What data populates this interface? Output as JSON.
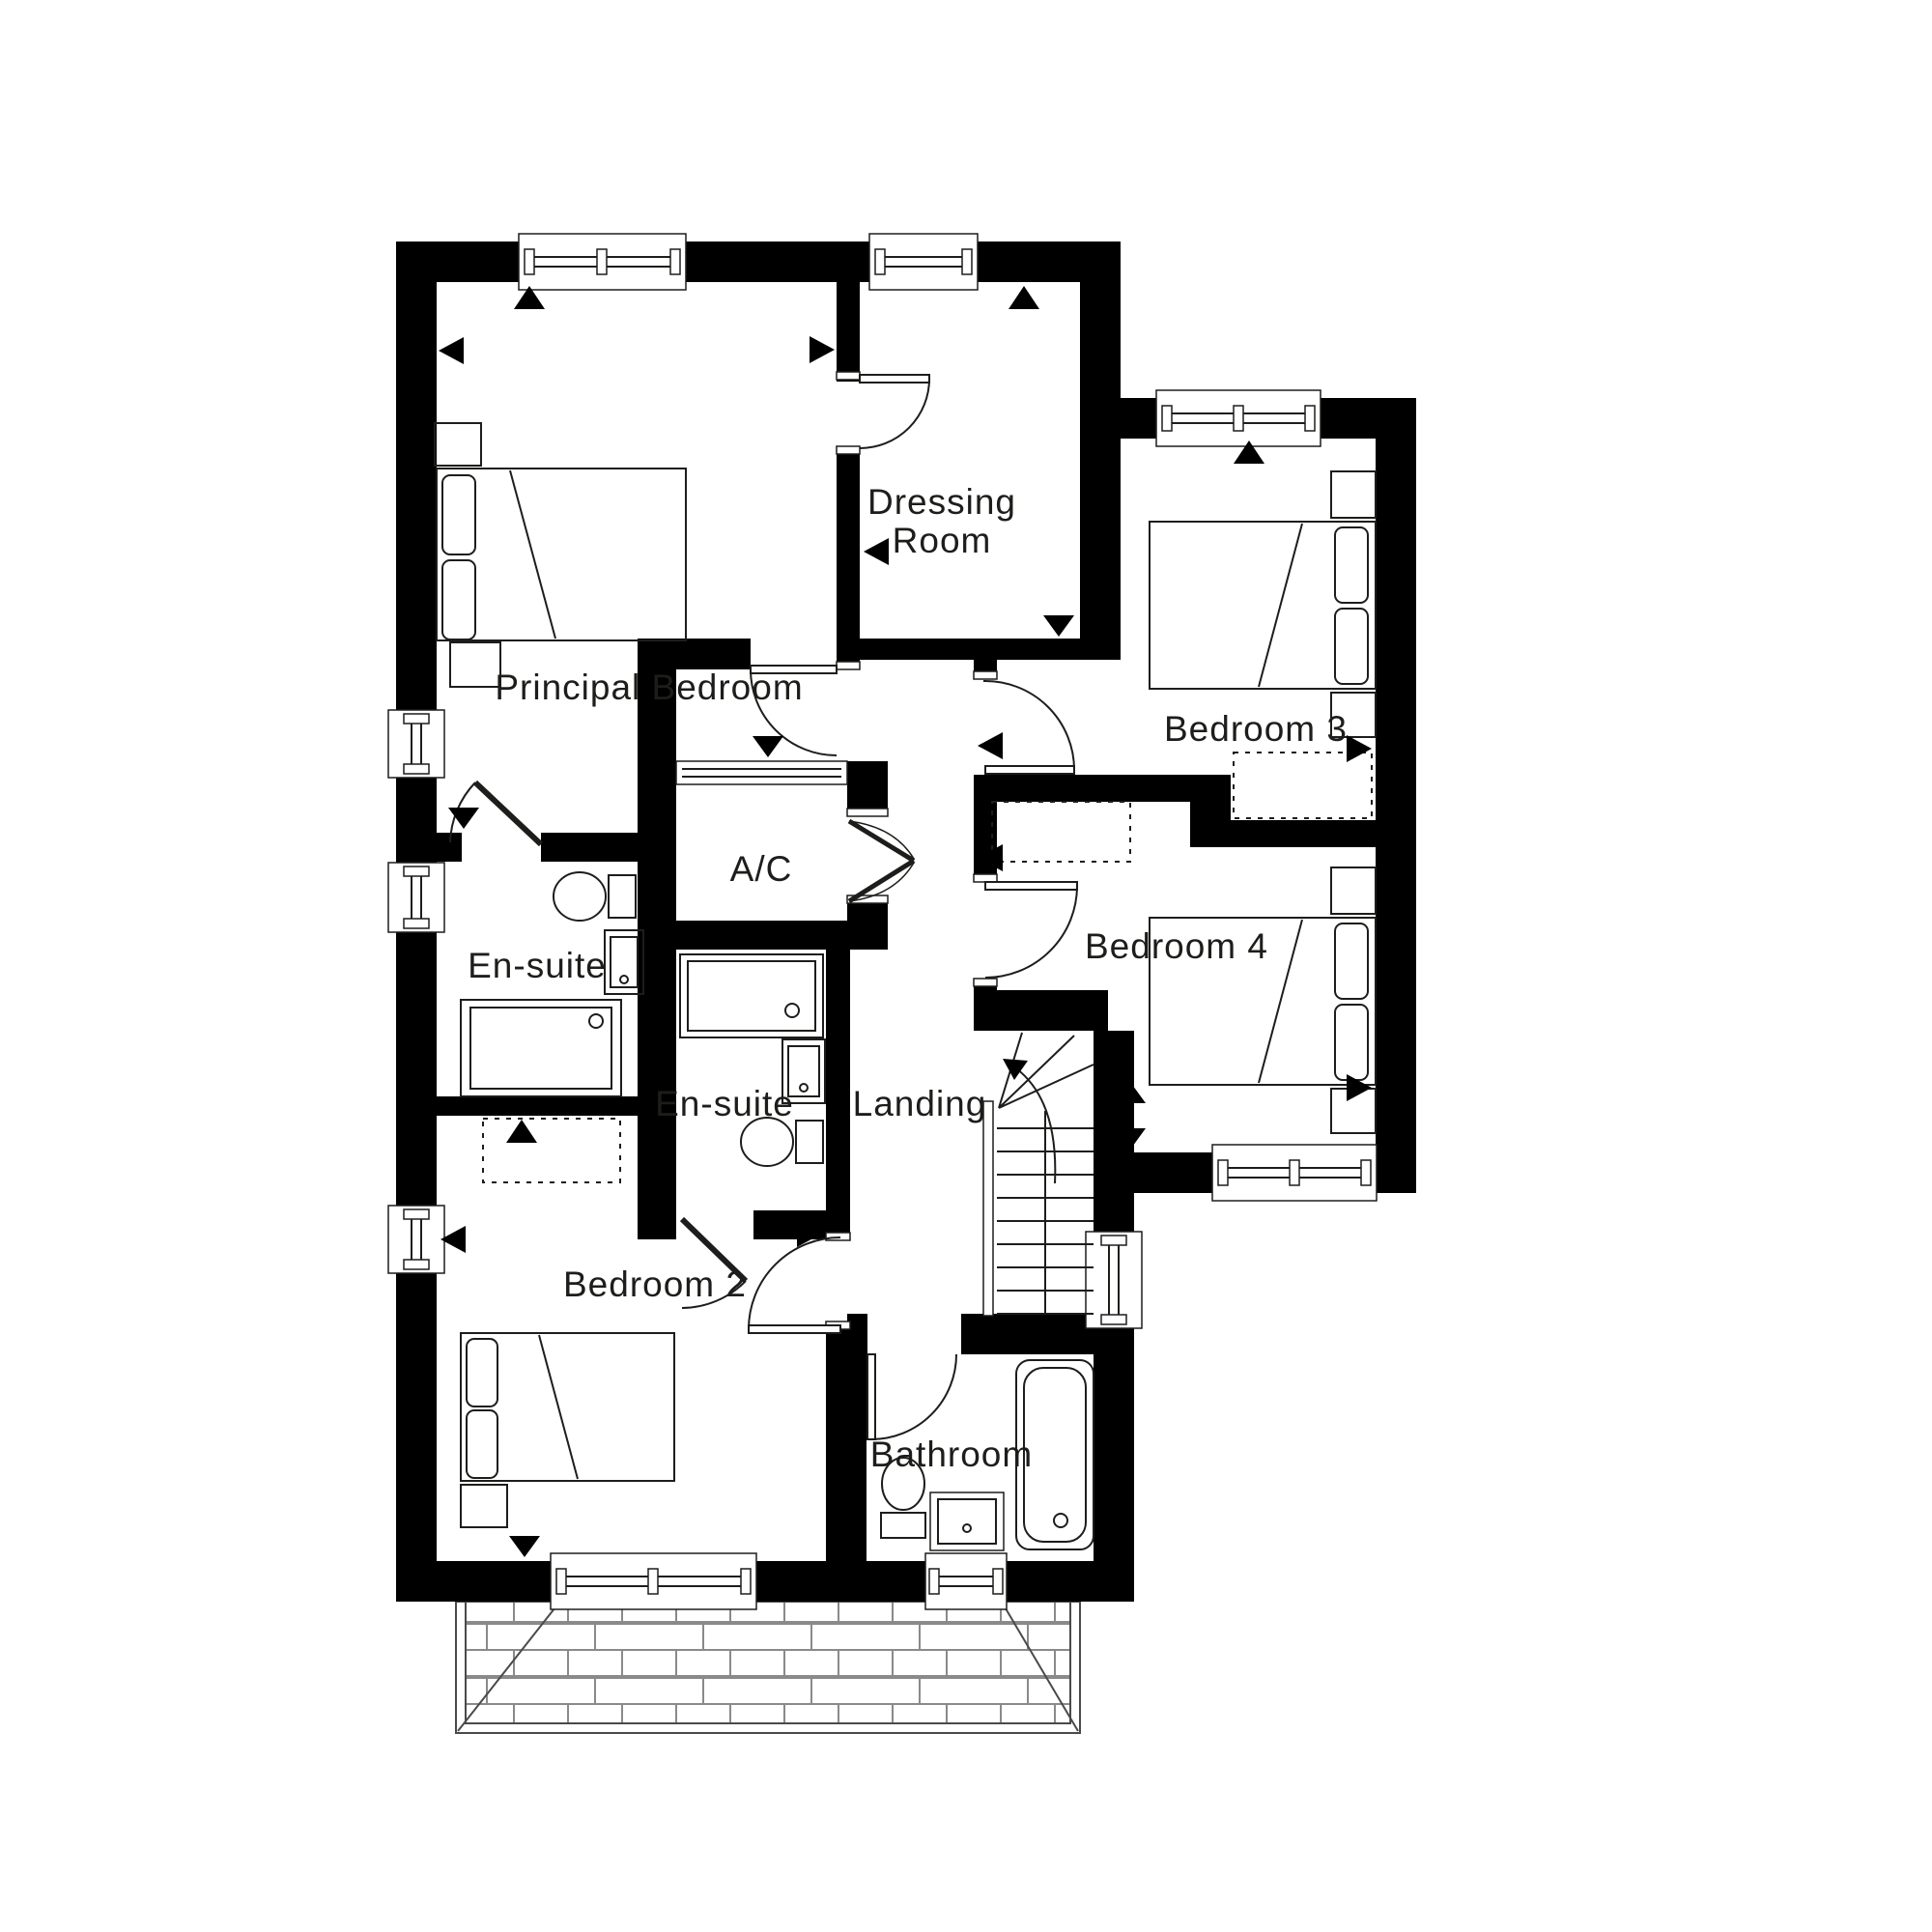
{
  "plan": {
    "title": "First floor plan",
    "rooms": {
      "principal_bedroom": "Principal Bedroom",
      "dressing_line1": "Dressing",
      "dressing_line2": "Room",
      "bedroom_3": "Bedroom 3",
      "bedroom_4": "Bedroom 4",
      "en_suite_principal": "En-suite",
      "en_suite_bedroom2": "En-suite",
      "ac_cupboard": "A/C",
      "landing": "Landing",
      "bedroom_2": "Bedroom 2",
      "bathroom": "Bathroom"
    },
    "fixtures": [
      "double-bed",
      "bedside-table",
      "pillow",
      "wardrobe-dashed",
      "toilet",
      "wash-basin",
      "shower-tray",
      "bath-tub",
      "staircase-up",
      "window",
      "door-swing",
      "bifold-door",
      "wall-marker-triangle",
      "brick-canopy"
    ],
    "colors": {
      "background": "#ffffff",
      "wall": "#000000",
      "line": "#1d1d1b",
      "brick_line": "#8a8a8a",
      "border_grey": "#4a4a4a"
    }
  }
}
